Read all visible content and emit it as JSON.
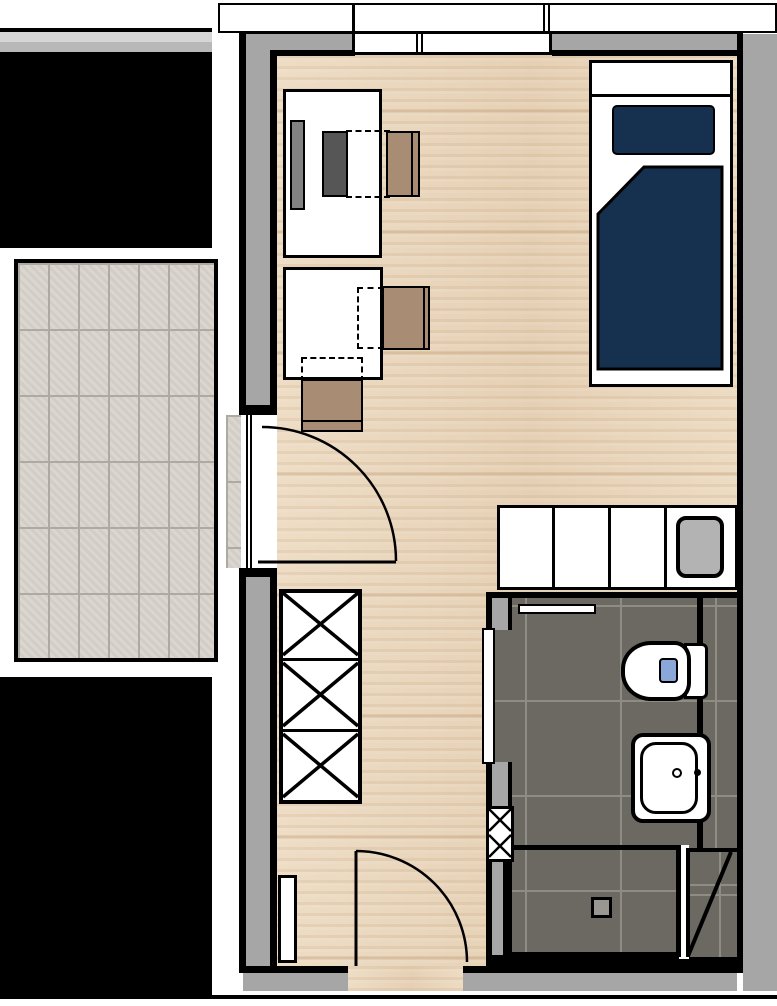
{
  "title": "studio-apartment-floor-plan",
  "colors": {
    "outline": "#000000",
    "exterior_white": "#ffffff",
    "wall_gray": "#a6a6a6",
    "band_gray_light": "#d6d6d6",
    "band_gray_mid": "#b8b8b8",
    "wood_base": "#ecd9bf",
    "balcony_tile": "#d9d5cd",
    "balcony_grout": "#aeaaa2",
    "bath_tile": "#6c6862",
    "bath_grout": "#8f8c84",
    "bed_navy": "#16304f",
    "chair_tan": "#a88d74",
    "monitor_gray": "#828282",
    "pc_dark_gray": "#565656",
    "appliance_gray": "#b3b3b3",
    "drain_gray": "#9a9792",
    "flush_blue": "#8ba7d9"
  },
  "legend": {
    "rooms": [
      "living-room",
      "bathroom",
      "balcony"
    ],
    "items": [
      "bed",
      "pillow",
      "duvet",
      "desk",
      "monitor",
      "office-chair",
      "dining-table",
      "side-chair",
      "wardrobe",
      "kitchenette-counter",
      "built-in-sink",
      "radiator",
      "towel-rail",
      "toilet",
      "washbasin",
      "shower",
      "floor-drain",
      "installation-duct",
      "balcony-door",
      "entry-door",
      "bathroom-door",
      "window"
    ]
  }
}
